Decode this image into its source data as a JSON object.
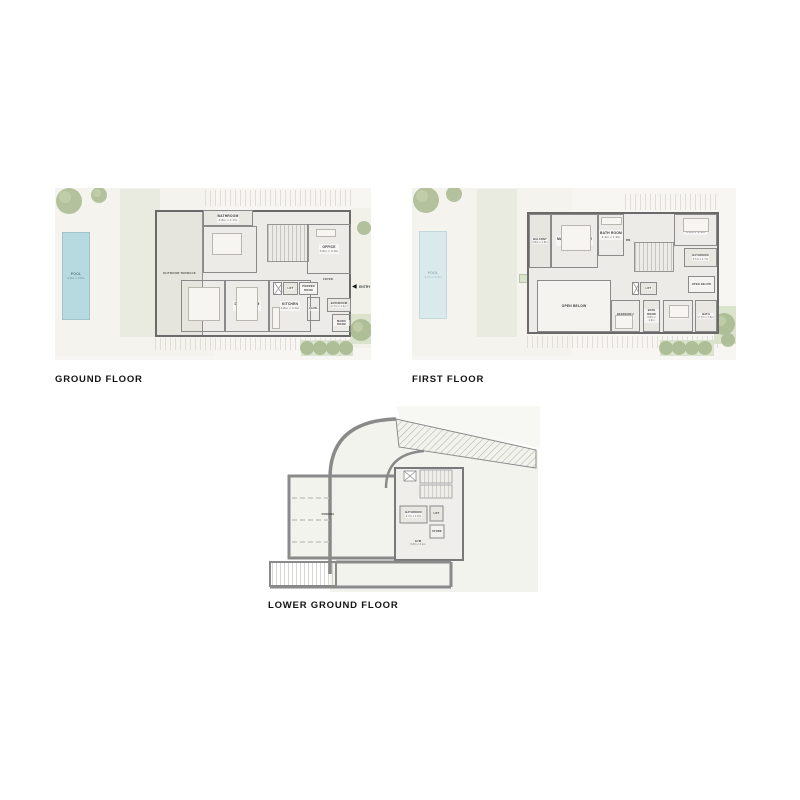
{
  "titles": {
    "ground": "GROUND FLOOR",
    "first": "FIRST FLOOR",
    "lower": "LOWER GROUND FLOOR"
  },
  "colors": {
    "pool": "#b7dae1",
    "tree": "#a3b689",
    "wall": "#6a6a6a"
  },
  "ground": {
    "pool": {
      "name": "POOL",
      "dims": "9.0m x 3.5m"
    },
    "terrace": {
      "name": "OUTDOOR TERRACE"
    },
    "bathroom_top": {
      "name": "BATHROOM",
      "dims": "3.8m x 1.7m"
    },
    "bedroom5": {
      "name": "BEDROOM 5",
      "dims": "4.7m x 4.4m"
    },
    "office": {
      "name": "OFFICE",
      "dims": "3.8m x 3.3m"
    },
    "living": {
      "name": "LIVING ROOM",
      "dims": "5.2m x 4.5m"
    },
    "dining": {
      "name": "DINING ROOM",
      "dims": "5.2m x 4.5m"
    },
    "kitchen": {
      "name": "KITCHEN",
      "dims": "3.8m x 4.3m"
    },
    "lift": {
      "name": "LIFT"
    },
    "powder": {
      "name": "POWDER ROOM"
    },
    "foyer": {
      "name": "FOYER"
    },
    "laundry": {
      "name": "LAUN."
    },
    "bathroom_entry": {
      "name": "BATHROOM",
      "dims": "2.7m x 1.4m"
    },
    "maids": {
      "name": "MAIDS ROOM"
    },
    "entry": {
      "name": "ENTRY"
    }
  },
  "first": {
    "pool": {
      "name": "POOL",
      "dims": "9.0m x 3.5m"
    },
    "planter": {
      "name": "PLANTER"
    },
    "balcony": {
      "name": "BALCONY",
      "dims": "3.8m x 1.8m"
    },
    "master": {
      "name": "MASTER BEDROOM",
      "dims": "5.0m x 5.3m"
    },
    "master_bath": {
      "name": "BATH ROOM",
      "dims": "4.4m x 1.9m"
    },
    "bedroom4": {
      "name": "BEDROOM 4",
      "dims": "3.8m x 4.4m"
    },
    "bathroom4": {
      "name": "BATHROOM",
      "dims": "3.1m x 1.7m"
    },
    "open_small": {
      "name": "OPEN BELOW"
    },
    "open_large": {
      "name": "OPEN BELOW"
    },
    "bedroom2": {
      "name": "BEDROOM 2",
      "dims": "4.2m x 3.7m"
    },
    "bath2": {
      "name": "BATH ROOM",
      "dims": "3.8m x 1.9m"
    },
    "bedroom3": {
      "name": "BEDROOM 3",
      "dims": "3.8m x 3.7m"
    },
    "bath3": {
      "name": "BATH",
      "dims": "2.7m x 1.8m"
    },
    "lift": {
      "name": "LIFT"
    },
    "dn": {
      "name": "DN"
    }
  },
  "lower": {
    "parking": {
      "name": "PARKING"
    },
    "bathroom": {
      "name": "BATHROOM",
      "dims": "2.7m x 1.8m"
    },
    "lift": {
      "name": "LIFT"
    },
    "store": {
      "name": "STORE"
    },
    "gym": {
      "name": "GYM",
      "dims": "3.8m x 4.1m"
    }
  }
}
